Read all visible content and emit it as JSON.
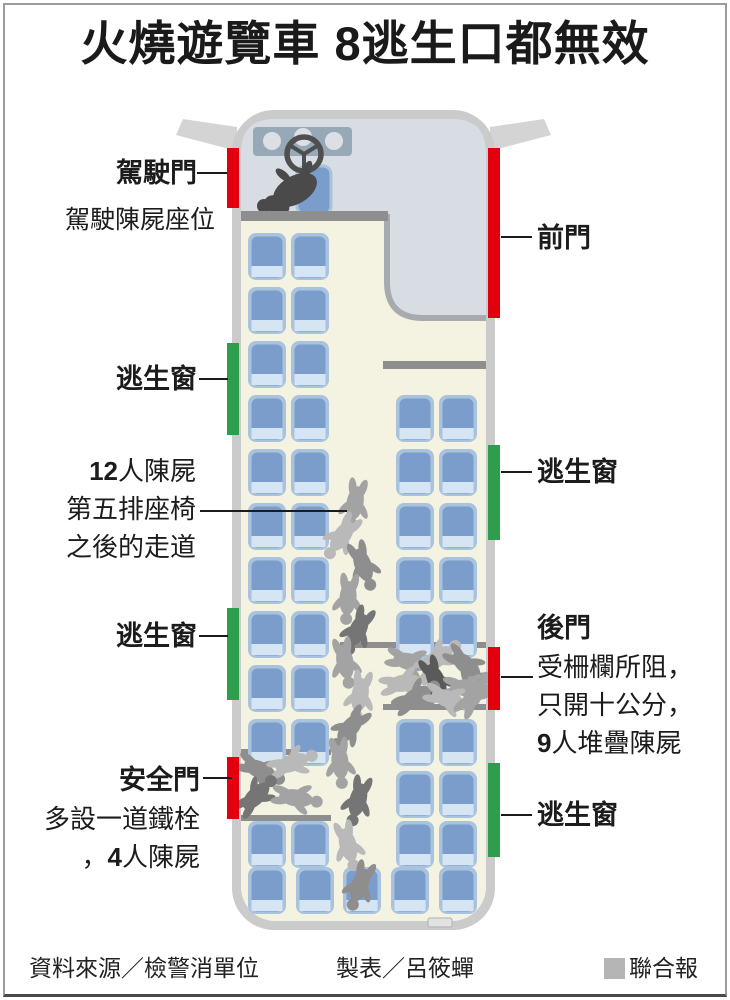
{
  "title": "火燒遊覽車 8逃生口都無效",
  "callouts": {
    "driver_door": {
      "label": "駕駛門"
    },
    "driver_seat_note": {
      "text": "駕駛陳屍座位"
    },
    "front_door": {
      "label": "前門"
    },
    "escape_window_left_1": {
      "label": "逃生窗"
    },
    "aisle_bodies": {
      "count": "12",
      "after_count": "人陳屍",
      "line2": "第五排座椅",
      "line3": "之後的走道"
    },
    "escape_window_right_1": {
      "label": "逃生窗"
    },
    "escape_window_left_2": {
      "label": "逃生窗"
    },
    "rear_door": {
      "label": "後門",
      "line1": "受柵欄所阻，",
      "line2": "只開十公分，",
      "count": "9",
      "after_count": "人堆疊陳屍"
    },
    "safety_door": {
      "label": "安全門",
      "line1": "多設一道鐵栓",
      "line2_prefix": "，",
      "count": "4",
      "after_count": "人陳屍"
    },
    "escape_window_right_2": {
      "label": "逃生窗"
    }
  },
  "footer": {
    "source": "資料來源／檢警消單位",
    "credit": "製表／呂筱蟬",
    "brand": "聯合報"
  },
  "diagram": {
    "colors": {
      "door": "#e2000f",
      "window": "#2f9e4c",
      "seat_edge": "#a9c3de",
      "seat_back": "#7b9dcb",
      "seat_cushion": "#d5e5f3",
      "brand_square": "#b5b5b5",
      "body_shades": [
        "#b9b9b9",
        "#a3a3a3",
        "#8e8e8e",
        "#757575",
        "#5a5a5a"
      ]
    },
    "exits": [
      {
        "id": "driver-door",
        "type": "door",
        "side": "left",
        "y": 148,
        "h": 60
      },
      {
        "id": "front-door",
        "type": "door",
        "side": "right",
        "y": 148,
        "h": 170
      },
      {
        "id": "escape-window-left-1",
        "type": "window",
        "side": "left",
        "y": 343,
        "h": 92
      },
      {
        "id": "escape-window-right-1",
        "type": "window",
        "side": "right",
        "y": 445,
        "h": 95
      },
      {
        "id": "escape-window-left-2",
        "type": "window",
        "side": "left",
        "y": 608,
        "h": 92
      },
      {
        "id": "rear-door",
        "type": "door",
        "side": "right",
        "y": 647,
        "h": 63
      },
      {
        "id": "safety-door",
        "type": "door",
        "side": "left",
        "y": 757,
        "h": 62
      },
      {
        "id": "escape-window-right-2",
        "type": "window",
        "side": "right",
        "y": 763,
        "h": 94
      }
    ],
    "seat_rows": [
      {
        "y": 233,
        "left": true,
        "right": false
      },
      {
        "y": 287,
        "left": true,
        "right": false
      },
      {
        "y": 341,
        "left": true,
        "right": false
      },
      {
        "y": 395,
        "left": true,
        "right": true
      },
      {
        "y": 449,
        "left": true,
        "right": true
      },
      {
        "y": 503,
        "left": true,
        "right": true
      },
      {
        "y": 557,
        "left": true,
        "right": true
      },
      {
        "y": 611,
        "left": true,
        "right": true
      },
      {
        "y": 665,
        "left": true,
        "right": false
      },
      {
        "y": 719,
        "left": true,
        "right": true
      },
      {
        "y": 771,
        "left": false,
        "right": true
      },
      {
        "y": 821,
        "left": true,
        "right": true
      }
    ],
    "back_row": {
      "y": 867,
      "xs": [
        248,
        296,
        343,
        391,
        439
      ]
    },
    "body_clusters": [
      {
        "id": "aisle-body-pile",
        "bodies": [
          [
            355,
            503,
            100,
            1
          ],
          [
            342,
            536,
            125,
            0
          ],
          [
            363,
            565,
            70,
            2
          ],
          [
            348,
            598,
            95,
            1
          ],
          [
            358,
            630,
            115,
            3
          ],
          [
            345,
            662,
            80,
            1
          ],
          [
            360,
            695,
            100,
            0
          ],
          [
            350,
            728,
            130,
            2
          ],
          [
            340,
            762,
            85,
            1
          ],
          [
            358,
            800,
            105,
            3
          ],
          [
            348,
            845,
            75,
            0
          ],
          [
            360,
            885,
            110,
            2
          ]
        ]
      },
      {
        "id": "rear-door-body-pile",
        "bodies": [
          [
            410,
            662,
            15,
            1
          ],
          [
            438,
            658,
            -35,
            0
          ],
          [
            466,
            665,
            40,
            2
          ],
          [
            404,
            683,
            -10,
            0
          ],
          [
            436,
            680,
            65,
            4
          ],
          [
            467,
            688,
            5,
            1
          ],
          [
            416,
            697,
            -30,
            2
          ],
          [
            448,
            699,
            20,
            0
          ],
          [
            474,
            695,
            -55,
            1
          ]
        ]
      },
      {
        "id": "safety-door-body-pile",
        "bodies": [
          [
            260,
            770,
            25,
            2
          ],
          [
            292,
            763,
            -20,
            0
          ],
          [
            256,
            796,
            -45,
            3
          ],
          [
            296,
            798,
            10,
            1
          ]
        ]
      }
    ]
  }
}
